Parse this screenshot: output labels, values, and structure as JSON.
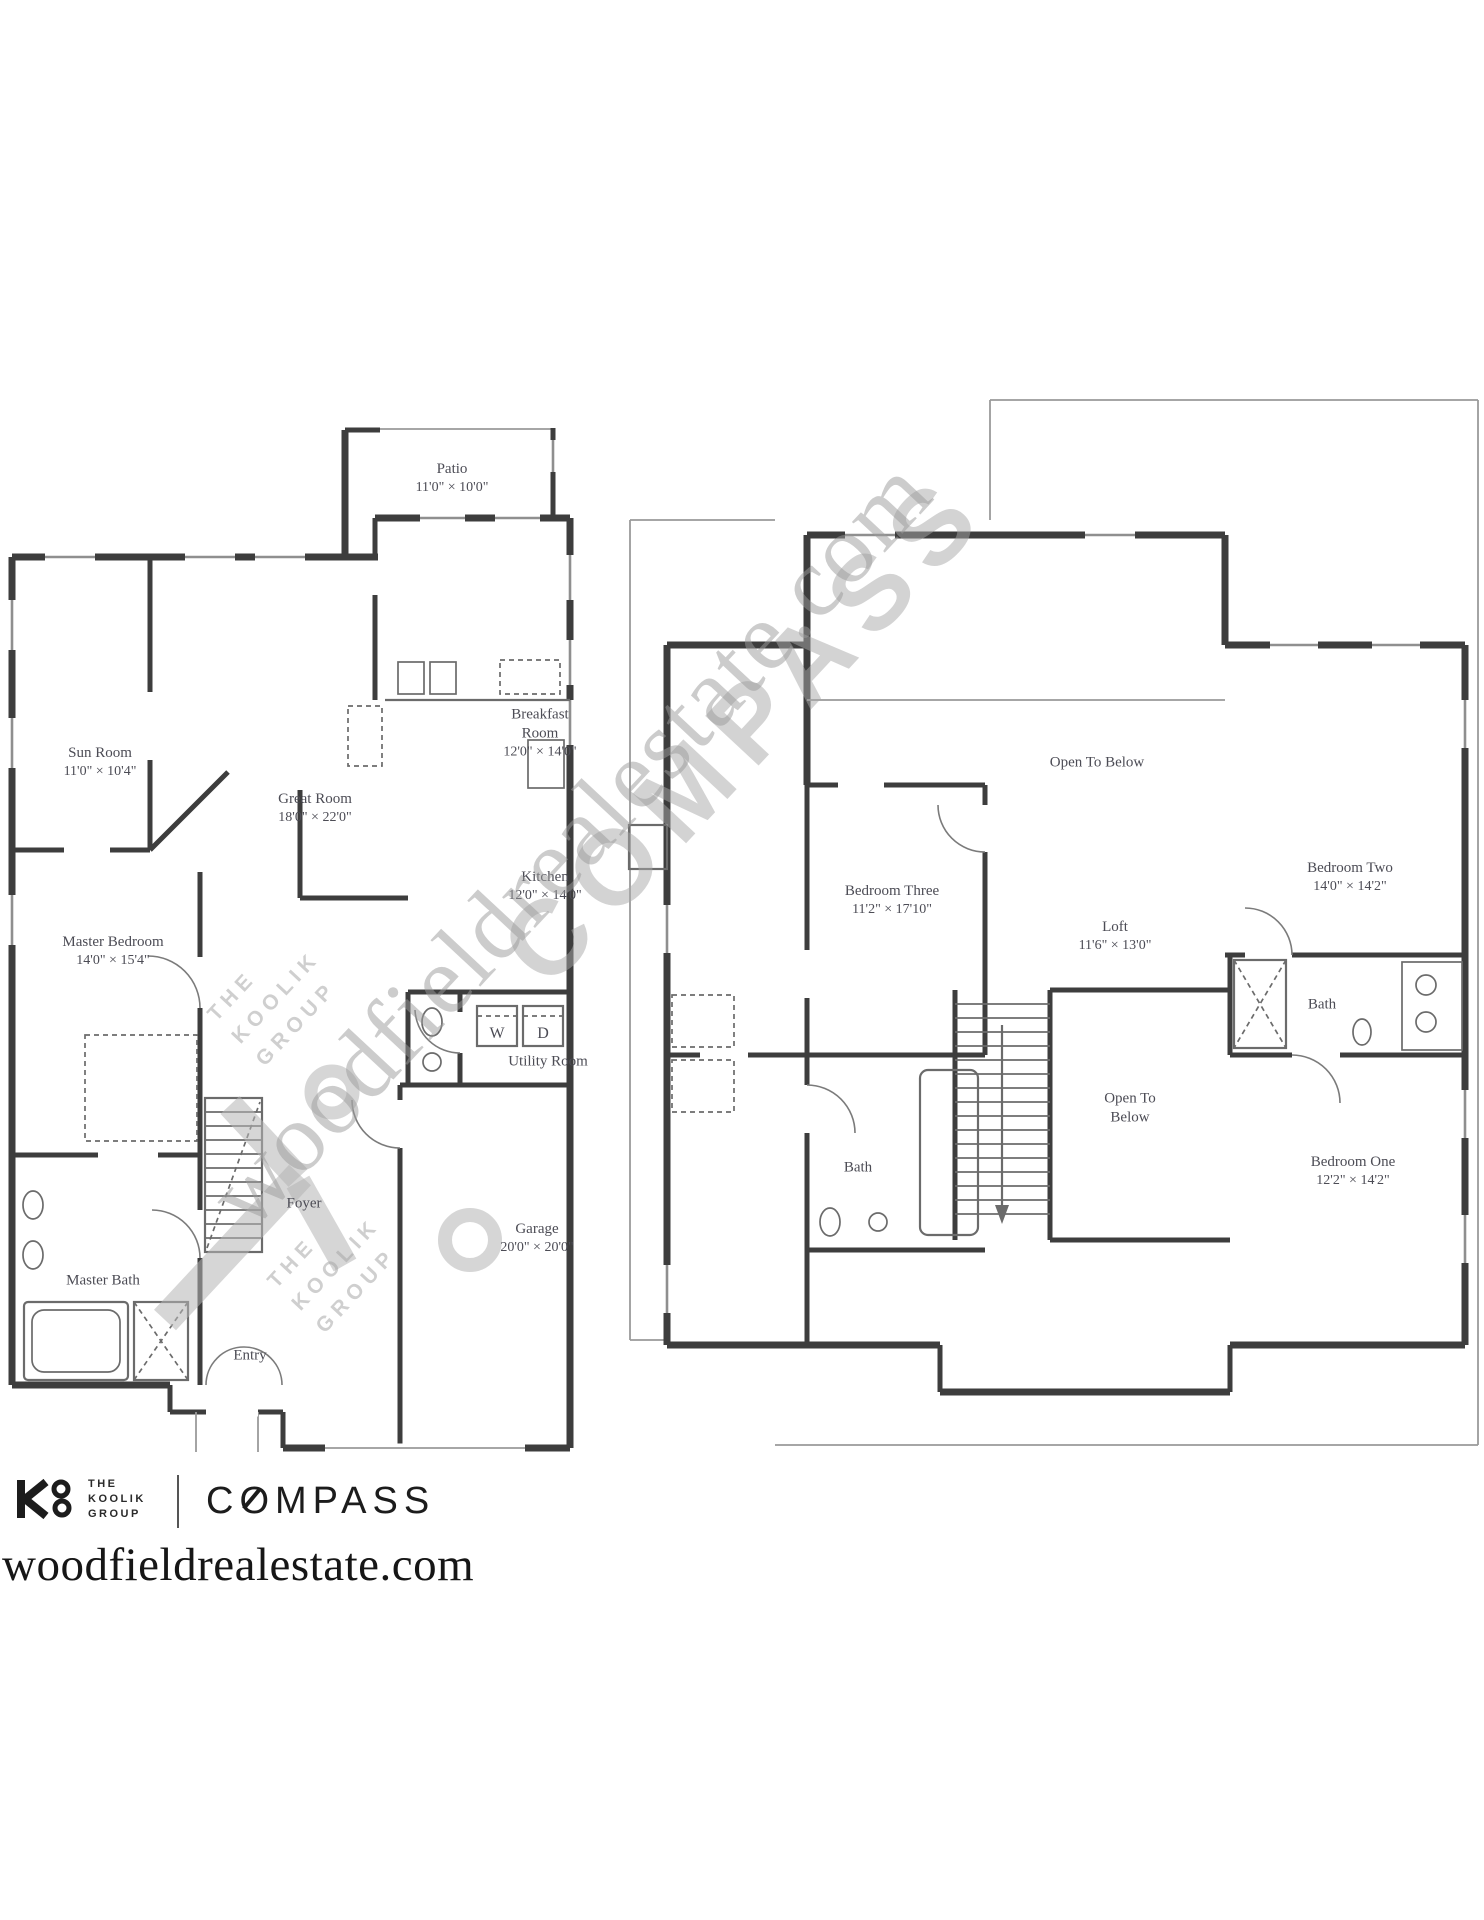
{
  "floor1": {
    "rooms": [
      {
        "name": "Patio",
        "dims": "11'0\" × 10'0\""
      },
      {
        "name": "Sun Room",
        "dims": "11'0\" × 10'4\""
      },
      {
        "name": "Great Room",
        "dims": "18'0\" × 22'0\""
      },
      {
        "name": "Breakfast Room",
        "dims": "12'0\" × 14'0\""
      },
      {
        "name": "Kitchen",
        "dims": "12'0\" × 14'0\""
      },
      {
        "name": "Master Bedroom",
        "dims": "14'0\" × 15'4\""
      },
      {
        "name": "Utility Room"
      },
      {
        "name": "Foyer"
      },
      {
        "name": "Garage",
        "dims": "20'0\" × 20'0\""
      },
      {
        "name": "Master Bath"
      },
      {
        "name": "Entry"
      }
    ],
    "appliances": {
      "washer": "W",
      "dryer": "D"
    }
  },
  "floor2": {
    "rooms": [
      {
        "name": "Open To Below"
      },
      {
        "name": "Bedroom Three",
        "dims": "11'2\" × 17'10\""
      },
      {
        "name": "Loft",
        "dims": "11'6\" × 13'0\""
      },
      {
        "name": "Bedroom Two",
        "dims": "14'0\" × 14'2\""
      },
      {
        "name": "Bath"
      },
      {
        "name": "Open To Below"
      },
      {
        "name": "Bath"
      },
      {
        "name": "Bedroom One",
        "dims": "12'2\" × 14'2\""
      }
    ]
  },
  "watermarks": {
    "compass": "COMPASS",
    "website": "woodfieldrealestate.com",
    "koolik": {
      "line1": "THE",
      "line2": "KOOLIK",
      "line3": "GROUP"
    }
  },
  "footer": {
    "brokerage": {
      "line1": "THE",
      "line2": "KOOLIK",
      "line3": "GROUP"
    },
    "brand": "COMPASS",
    "website": "woodfieldrealestate.com"
  },
  "colors": {
    "wall": "#3d3d3d",
    "thin_line": "#9a9a9a",
    "label_ink": "#4c4c55",
    "watermark": "#a8a8a8",
    "brand_ink": "#1c1c1c",
    "background": "#ffffff"
  }
}
